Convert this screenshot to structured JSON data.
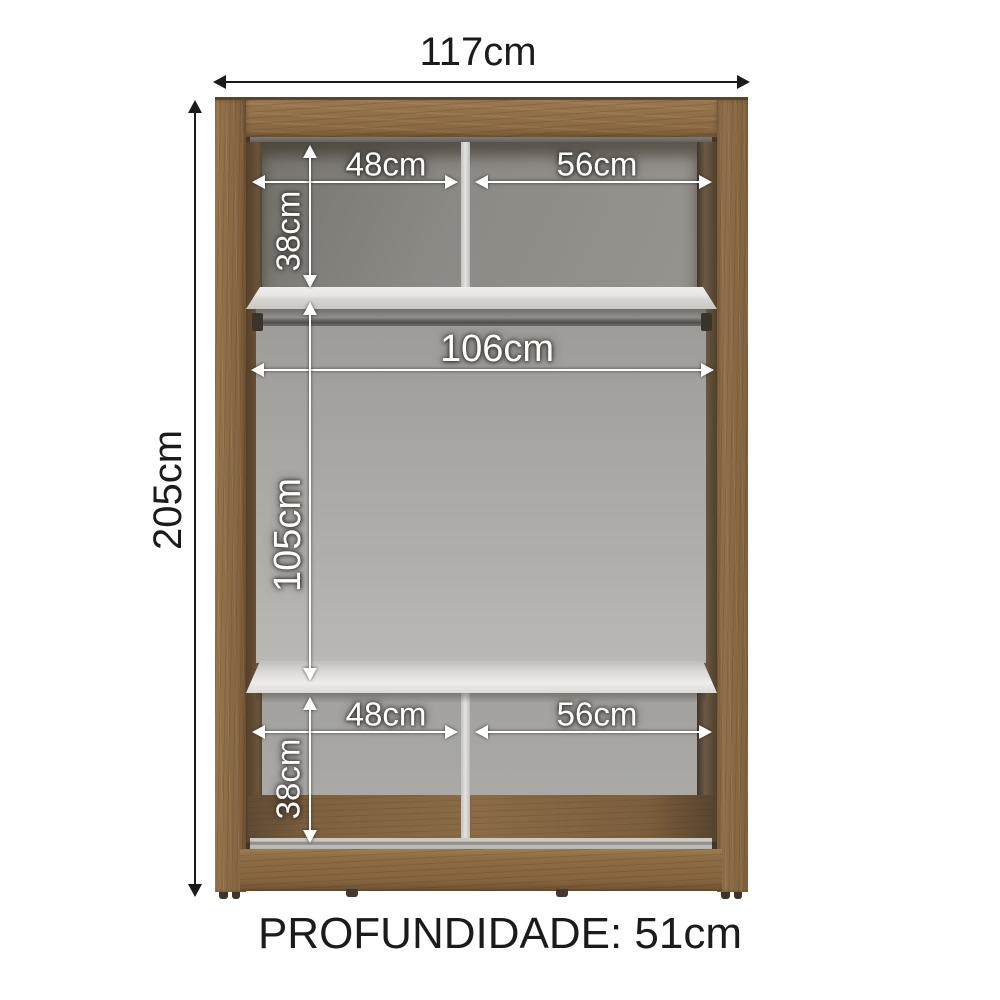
{
  "diagram": {
    "overall": {
      "width_label": "117cm",
      "height_label": "205cm",
      "depth_label": "PROFUNDIDADE: 51cm"
    },
    "top_section": {
      "left_width": "48cm",
      "right_width": "56cm",
      "height": "38cm"
    },
    "middle_section": {
      "width": "106cm",
      "height": "105cm"
    },
    "bottom_section": {
      "left_width": "48cm",
      "right_width": "56cm",
      "height": "38cm"
    },
    "colors": {
      "wood": "#8b6b46",
      "wood_dark": "#5a4732",
      "interior_shadow": "#43372a",
      "back_panel_grey": "#a5a4a0",
      "shelf_white": "#e9e8e6",
      "rod_grey": "#55544f",
      "annotation_white": "#ffffff",
      "annotation_black": "#1b1b1b",
      "background": "#ffffff"
    }
  }
}
